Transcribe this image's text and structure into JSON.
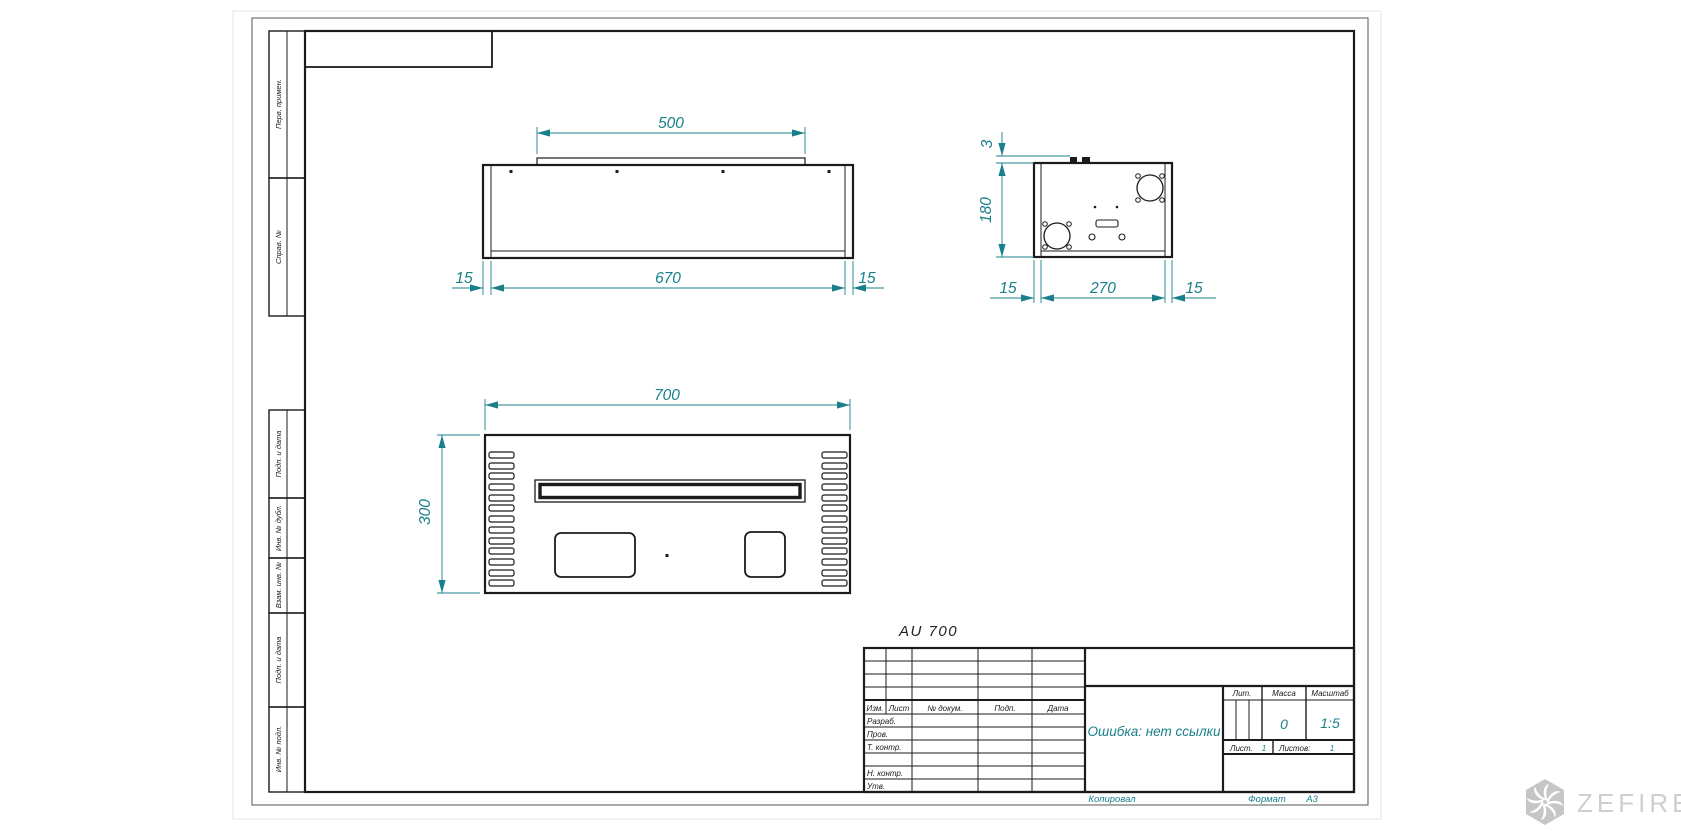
{
  "drawing": {
    "label": "AU 700",
    "dims": {
      "front_top": "500",
      "front_width": "670",
      "front_left": "15",
      "front_right": "15",
      "side_flange": "3",
      "side_height": "180",
      "side_left": "15",
      "side_depth": "270",
      "side_right": "15",
      "plan_width": "700",
      "plan_depth": "300"
    }
  },
  "margin_labels": [
    "Перв. примен.",
    "Справ. №",
    "Подп. и дата",
    "Инв. № дубл.",
    "Взам. инв. №",
    "Подп. и дата",
    "Инв. № подл."
  ],
  "title_block": {
    "change_cols": [
      "Изм.",
      "Лист",
      "№ докум.",
      "Подп.",
      "Дата"
    ],
    "role_rows": [
      "Разраб.",
      "Пров.",
      "Т. контр.",
      "Н. контр.",
      "Утв."
    ],
    "name_value": "Ошибка: нет ссылки",
    "lit": "Лит.",
    "mass": "Масса",
    "scale": "Масштаб",
    "mass_value": "0",
    "scale_value": "1:5",
    "sheet": "Лист.",
    "sheet_value": "1",
    "sheets": "Листов:",
    "sheets_value": "1",
    "copied": "Копировал",
    "format": "Формат",
    "format_value": "А3"
  },
  "watermark": {
    "brand": "ZEFIRE"
  },
  "colors": {
    "dim_teal": "#19808b",
    "line_black": "#1b1b1b",
    "watermark_gray": "#c6c6c6"
  }
}
